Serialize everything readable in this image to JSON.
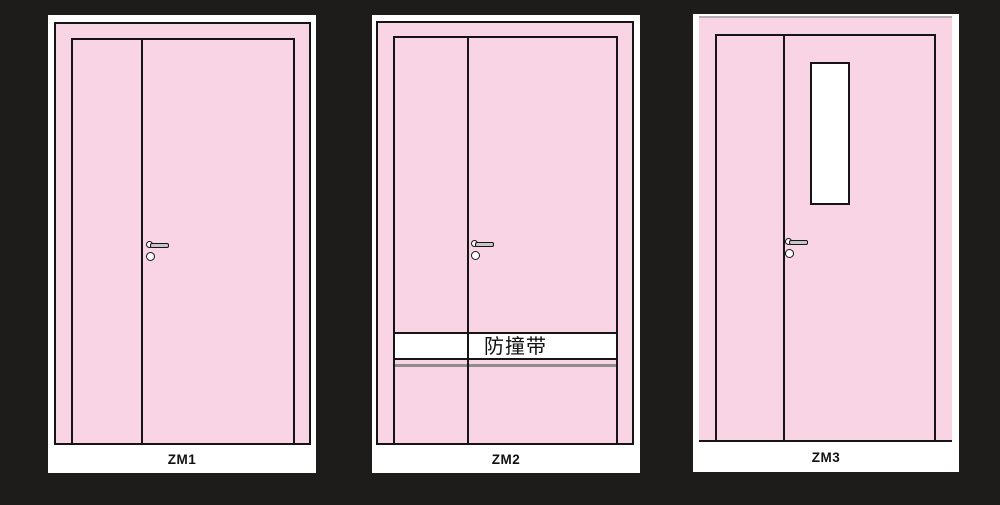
{
  "figure": {
    "kind": "door-elevation-diagrams",
    "background_color": "#1e1b1b"
  },
  "colors": {
    "background": "#1e1b1b",
    "card": "#ffffff",
    "door": "#f8d4e4",
    "line": "#151515",
    "band_shadow": "#8f8b8f",
    "lever": "#c6c6c6",
    "zm3_top_border": "#b3b0b3",
    "text": "#111111"
  },
  "doors": [
    {
      "label": "ZM1"
    },
    {
      "label": "ZM2",
      "band_label": "防撞带"
    },
    {
      "label": "ZM3"
    }
  ]
}
